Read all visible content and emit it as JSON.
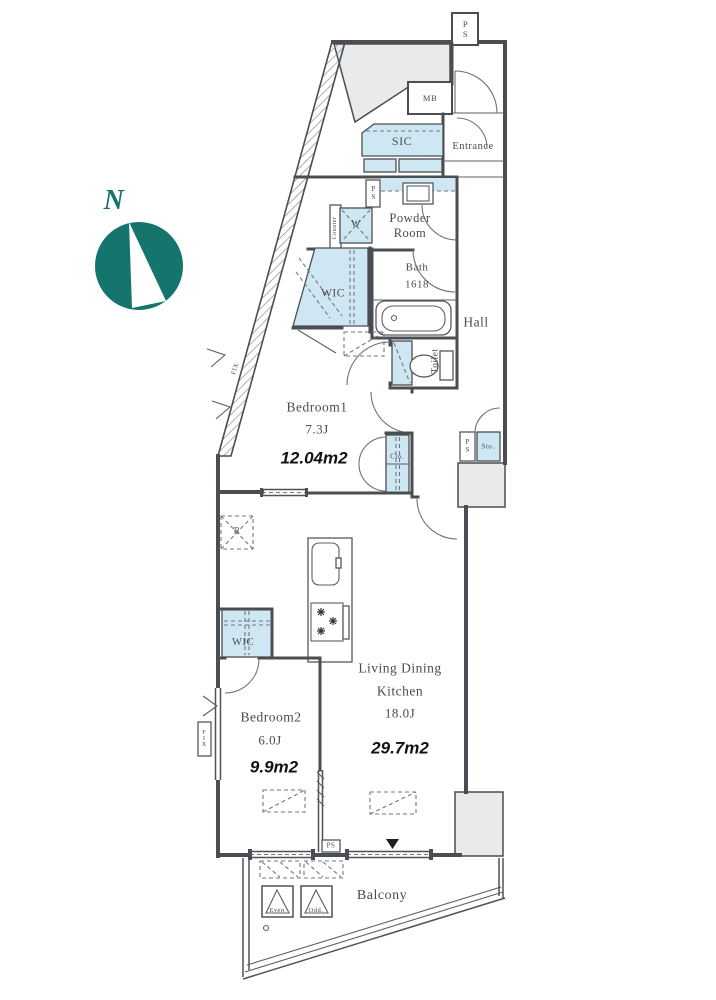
{
  "compass": {
    "north": "N"
  },
  "rooms": {
    "entrance": {
      "name": "Entrance"
    },
    "sic": {
      "name": "SIC"
    },
    "powder_room": {
      "name_line1": "Powder",
      "name_line2": "Room"
    },
    "bath": {
      "name": "Bath",
      "size": "1618"
    },
    "toilet": {
      "name": "Toilet"
    },
    "hall": {
      "name": "Hall"
    },
    "wic_north": {
      "name": "WIC"
    },
    "closet": {
      "name": "Clo."
    },
    "storage": {
      "name": "Sto."
    },
    "wic_south": {
      "name": "WIC"
    },
    "bedroom1": {
      "name": "Bedroom1",
      "tatami": "7.3J",
      "area": "12.04m2"
    },
    "bedroom2": {
      "name": "Bedroom2",
      "tatami": "6.0J",
      "area": "9.9m2"
    },
    "ldk": {
      "name_line1": "Living Dining",
      "name_line2": "Kitchen",
      "tatami": "18.0J",
      "area": "29.7m2"
    },
    "balcony": {
      "name": "Balcony"
    }
  },
  "fixtures": {
    "meter_box": "MB",
    "washer": "W",
    "counter": "Counter",
    "fridge": "R"
  },
  "shafts": {
    "ps_top": "PS",
    "ps_powder": "PS",
    "ps_hall": "PS",
    "ps_balcony": "PS"
  },
  "windows": {
    "fix_diagonal": "FIX",
    "fix_left": "FIX"
  },
  "balcony_markers": {
    "even": "Even",
    "odd": "Odd."
  },
  "colors": {
    "closet_fill": "#cfe7f3",
    "common_area_fill": "#e8eaeb",
    "wall": "#4a4e52",
    "compass_teal": "#15756d",
    "label_text": "#4b4b4b",
    "area_text": "#111111"
  }
}
